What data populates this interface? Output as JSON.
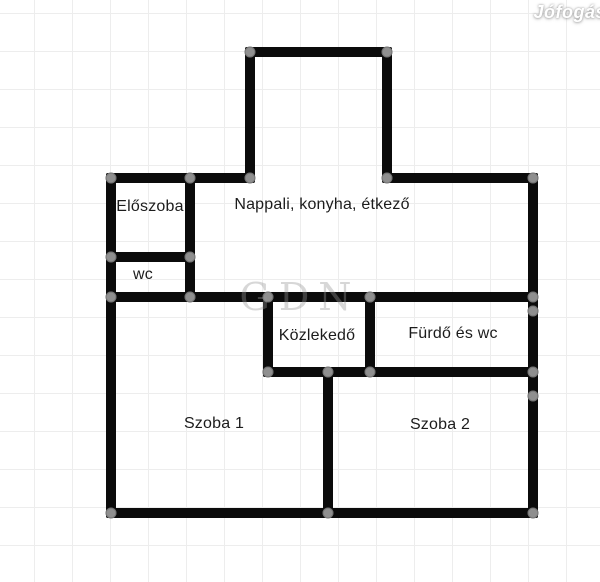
{
  "watermark": {
    "brand": "Jófogás",
    "ghost_brand": "GDN"
  },
  "colors": {
    "wall": "#0b0b0b",
    "handle": "#8f8f8f",
    "grid": "#ededed",
    "background": "#ffffff",
    "label_text": "#1c1c1c"
  },
  "floorplan": {
    "rooms": [
      {
        "id": "eloszoba",
        "label": "Előszoba",
        "cx": 150,
        "cy": 207
      },
      {
        "id": "wc",
        "label": "wc",
        "cx": 143,
        "cy": 275
      },
      {
        "id": "nappali",
        "label": "Nappali, konyha, étkező",
        "cx": 322,
        "cy": 205
      },
      {
        "id": "kozlekedo",
        "label": "Közlekedő",
        "cx": 317,
        "cy": 336
      },
      {
        "id": "furdo",
        "label": "Fürdő és wc",
        "cx": 453,
        "cy": 334
      },
      {
        "id": "szoba1",
        "label": "Szoba 1",
        "cx": 214,
        "cy": 424
      },
      {
        "id": "szoba2",
        "label": "Szoba 2",
        "cx": 440,
        "cy": 425
      }
    ],
    "walls": [
      {
        "name": "bay-top-wall",
        "x": 245,
        "y": 47,
        "w": 147,
        "h": 10
      },
      {
        "name": "bay-left-wall",
        "x": 245,
        "y": 47,
        "w": 10,
        "h": 136
      },
      {
        "name": "bay-right-wall",
        "x": 382,
        "y": 47,
        "w": 10,
        "h": 136
      },
      {
        "name": "top-left-wall",
        "x": 106,
        "y": 173,
        "w": 149,
        "h": 10
      },
      {
        "name": "top-right-wall",
        "x": 382,
        "y": 173,
        "w": 156,
        "h": 10
      },
      {
        "name": "left-outer-wall",
        "x": 106,
        "y": 173,
        "w": 10,
        "h": 345
      },
      {
        "name": "right-outer-wall",
        "x": 528,
        "y": 173,
        "w": 10,
        "h": 345
      },
      {
        "name": "bottom-outer-wall",
        "x": 106,
        "y": 508,
        "w": 432,
        "h": 10
      },
      {
        "name": "eloszoba-right-wall",
        "x": 185,
        "y": 173,
        "w": 10,
        "h": 129
      },
      {
        "name": "eloszoba-wc-divider",
        "x": 106,
        "y": 252,
        "w": 89,
        "h": 10
      },
      {
        "name": "middle-divider-wall",
        "x": 106,
        "y": 292,
        "w": 432,
        "h": 10
      },
      {
        "name": "kozlekedo-left-wall",
        "x": 263,
        "y": 292,
        "w": 10,
        "h": 85
      },
      {
        "name": "kozlekedo-right-wall",
        "x": 365,
        "y": 292,
        "w": 10,
        "h": 85
      },
      {
        "name": "hall-bottom-wall",
        "x": 263,
        "y": 367,
        "w": 275,
        "h": 10
      },
      {
        "name": "szoba-divider-wall",
        "x": 323,
        "y": 367,
        "w": 10,
        "h": 151
      }
    ],
    "handles": [
      {
        "x": 250,
        "y": 52
      },
      {
        "x": 387,
        "y": 52
      },
      {
        "x": 111,
        "y": 178
      },
      {
        "x": 190,
        "y": 178
      },
      {
        "x": 250,
        "y": 178
      },
      {
        "x": 387,
        "y": 178
      },
      {
        "x": 533,
        "y": 178
      },
      {
        "x": 111,
        "y": 257
      },
      {
        "x": 190,
        "y": 257
      },
      {
        "x": 111,
        "y": 297
      },
      {
        "x": 190,
        "y": 297
      },
      {
        "x": 268,
        "y": 297
      },
      {
        "x": 370,
        "y": 297
      },
      {
        "x": 533,
        "y": 297
      },
      {
        "x": 533,
        "y": 311
      },
      {
        "x": 268,
        "y": 372
      },
      {
        "x": 328,
        "y": 372
      },
      {
        "x": 370,
        "y": 372
      },
      {
        "x": 533,
        "y": 372
      },
      {
        "x": 533,
        "y": 396
      },
      {
        "x": 111,
        "y": 513
      },
      {
        "x": 328,
        "y": 513
      },
      {
        "x": 533,
        "y": 513
      }
    ]
  }
}
